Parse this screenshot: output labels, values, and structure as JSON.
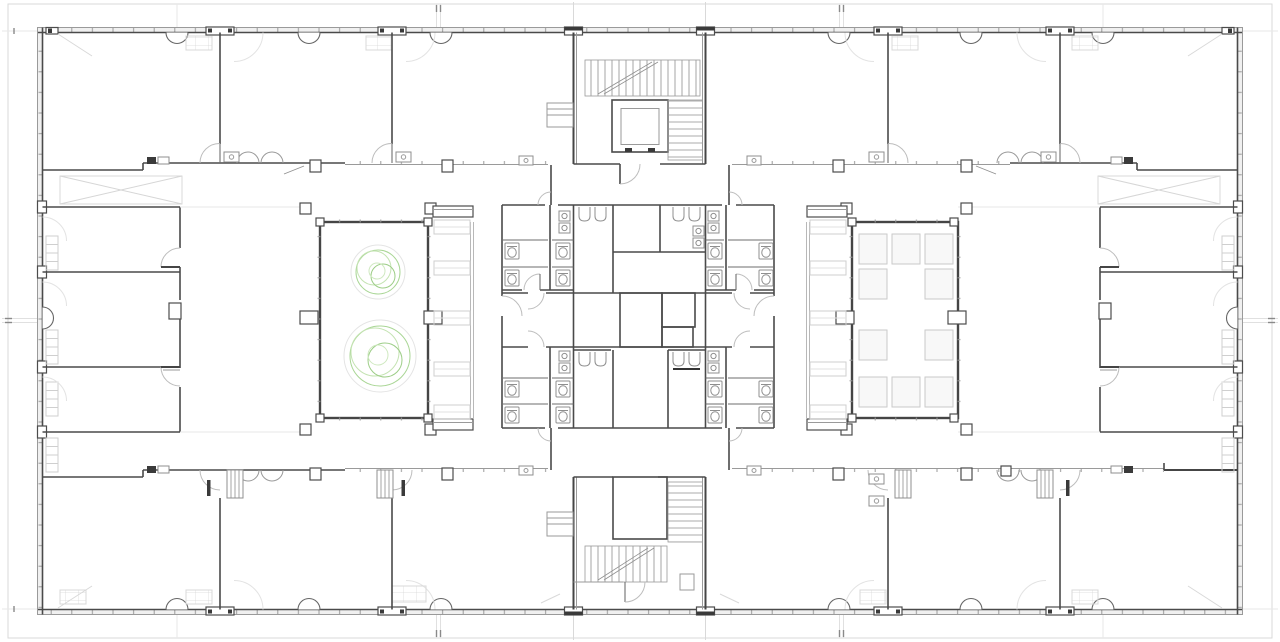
{
  "page": {
    "title": "Floor plan drawing",
    "type": "architectural floor plan (CAD line drawing, top-down view)",
    "description": "Black-and-white CAD floor plan of a rectangular office building level: perimeter rooms along the top, bottom, left and right facades, two internal courtyards (left one with two trees drawn in green, right one with a grid of skylight panels), two stair and elevator cores at top-center and bottom-center, and a central sanitary block with toilets, urinals and sinks. A faint structural grid and site boundary surround the building."
  },
  "plan": {
    "canvas": {
      "width": 1280,
      "height": 642,
      "background": "#ffffff"
    },
    "colors": {
      "wall_dark": "#454545",
      "wall_medium": "#8f8f8f",
      "wall_light": "#9a9a9a",
      "furniture_light": "#cfcfcf",
      "grid_line": "#e0e0e0",
      "site_boundary": "#d9d9d9",
      "tree_green": "#a9d695",
      "tree_green_light": "#c4e3b2",
      "tree_green_dark": "#9ccd86",
      "tree_halo_gray": "#e4e4e4",
      "skylight_stroke": "#c9c9c9",
      "skylight_fill": "#f8f8f8"
    },
    "contents": {
      "courtyards": [
        {
          "side": "left",
          "trees": 2,
          "window_mullions": true
        },
        {
          "side": "right",
          "skylight_panels": 10,
          "window_mullions": true
        }
      ],
      "cores": [
        {
          "position": "top-center",
          "elevator": true,
          "stair_flights": 2
        },
        {
          "position": "bottom-center",
          "elevator_shaft": true,
          "stair_flights": 2
        }
      ],
      "sanitary_block": {
        "toilets": 16,
        "urinals": 8,
        "sinks": 8,
        "stalls": 8
      },
      "perimeter_rooms": {
        "top_band": 6,
        "bottom_band": 6,
        "left_wing": 3,
        "right_wing": 3
      },
      "facade": {
        "column_half_round_bumps": 14,
        "window_mullion_strips": 4
      },
      "text_labels": []
    }
  }
}
